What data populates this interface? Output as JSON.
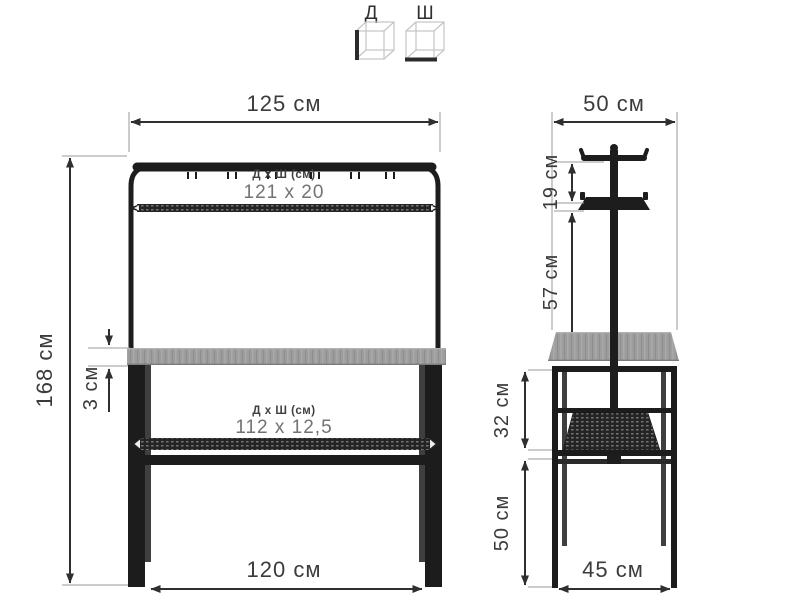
{
  "legend": {
    "length_label": "Д",
    "width_label": "Ш"
  },
  "front_view": {
    "width_top": "125 см",
    "height": "168 см",
    "tabletop_thickness": "3 см",
    "width_bottom": "120 см",
    "top_shelf": {
      "label": "Д х Ш (см)",
      "value": "121 х 20"
    },
    "bottom_shelf": {
      "label": "Д х Ш (см)",
      "value": "112 х 12,5"
    }
  },
  "side_view": {
    "width_top": "50 см",
    "hook_to_tray": "19 см",
    "tray_to_tabletop": "57 см",
    "tabletop_to_rail": "32 см",
    "rail_to_floor": "50 см",
    "width_bottom": "45 см"
  },
  "colors": {
    "frame": "#1d1d1d",
    "wood_top": "#9c9c9c",
    "dimension_line": "#2f2f2f",
    "label_text": "#3b3b3b",
    "value_text": "#737373",
    "background": "#ffffff"
  }
}
